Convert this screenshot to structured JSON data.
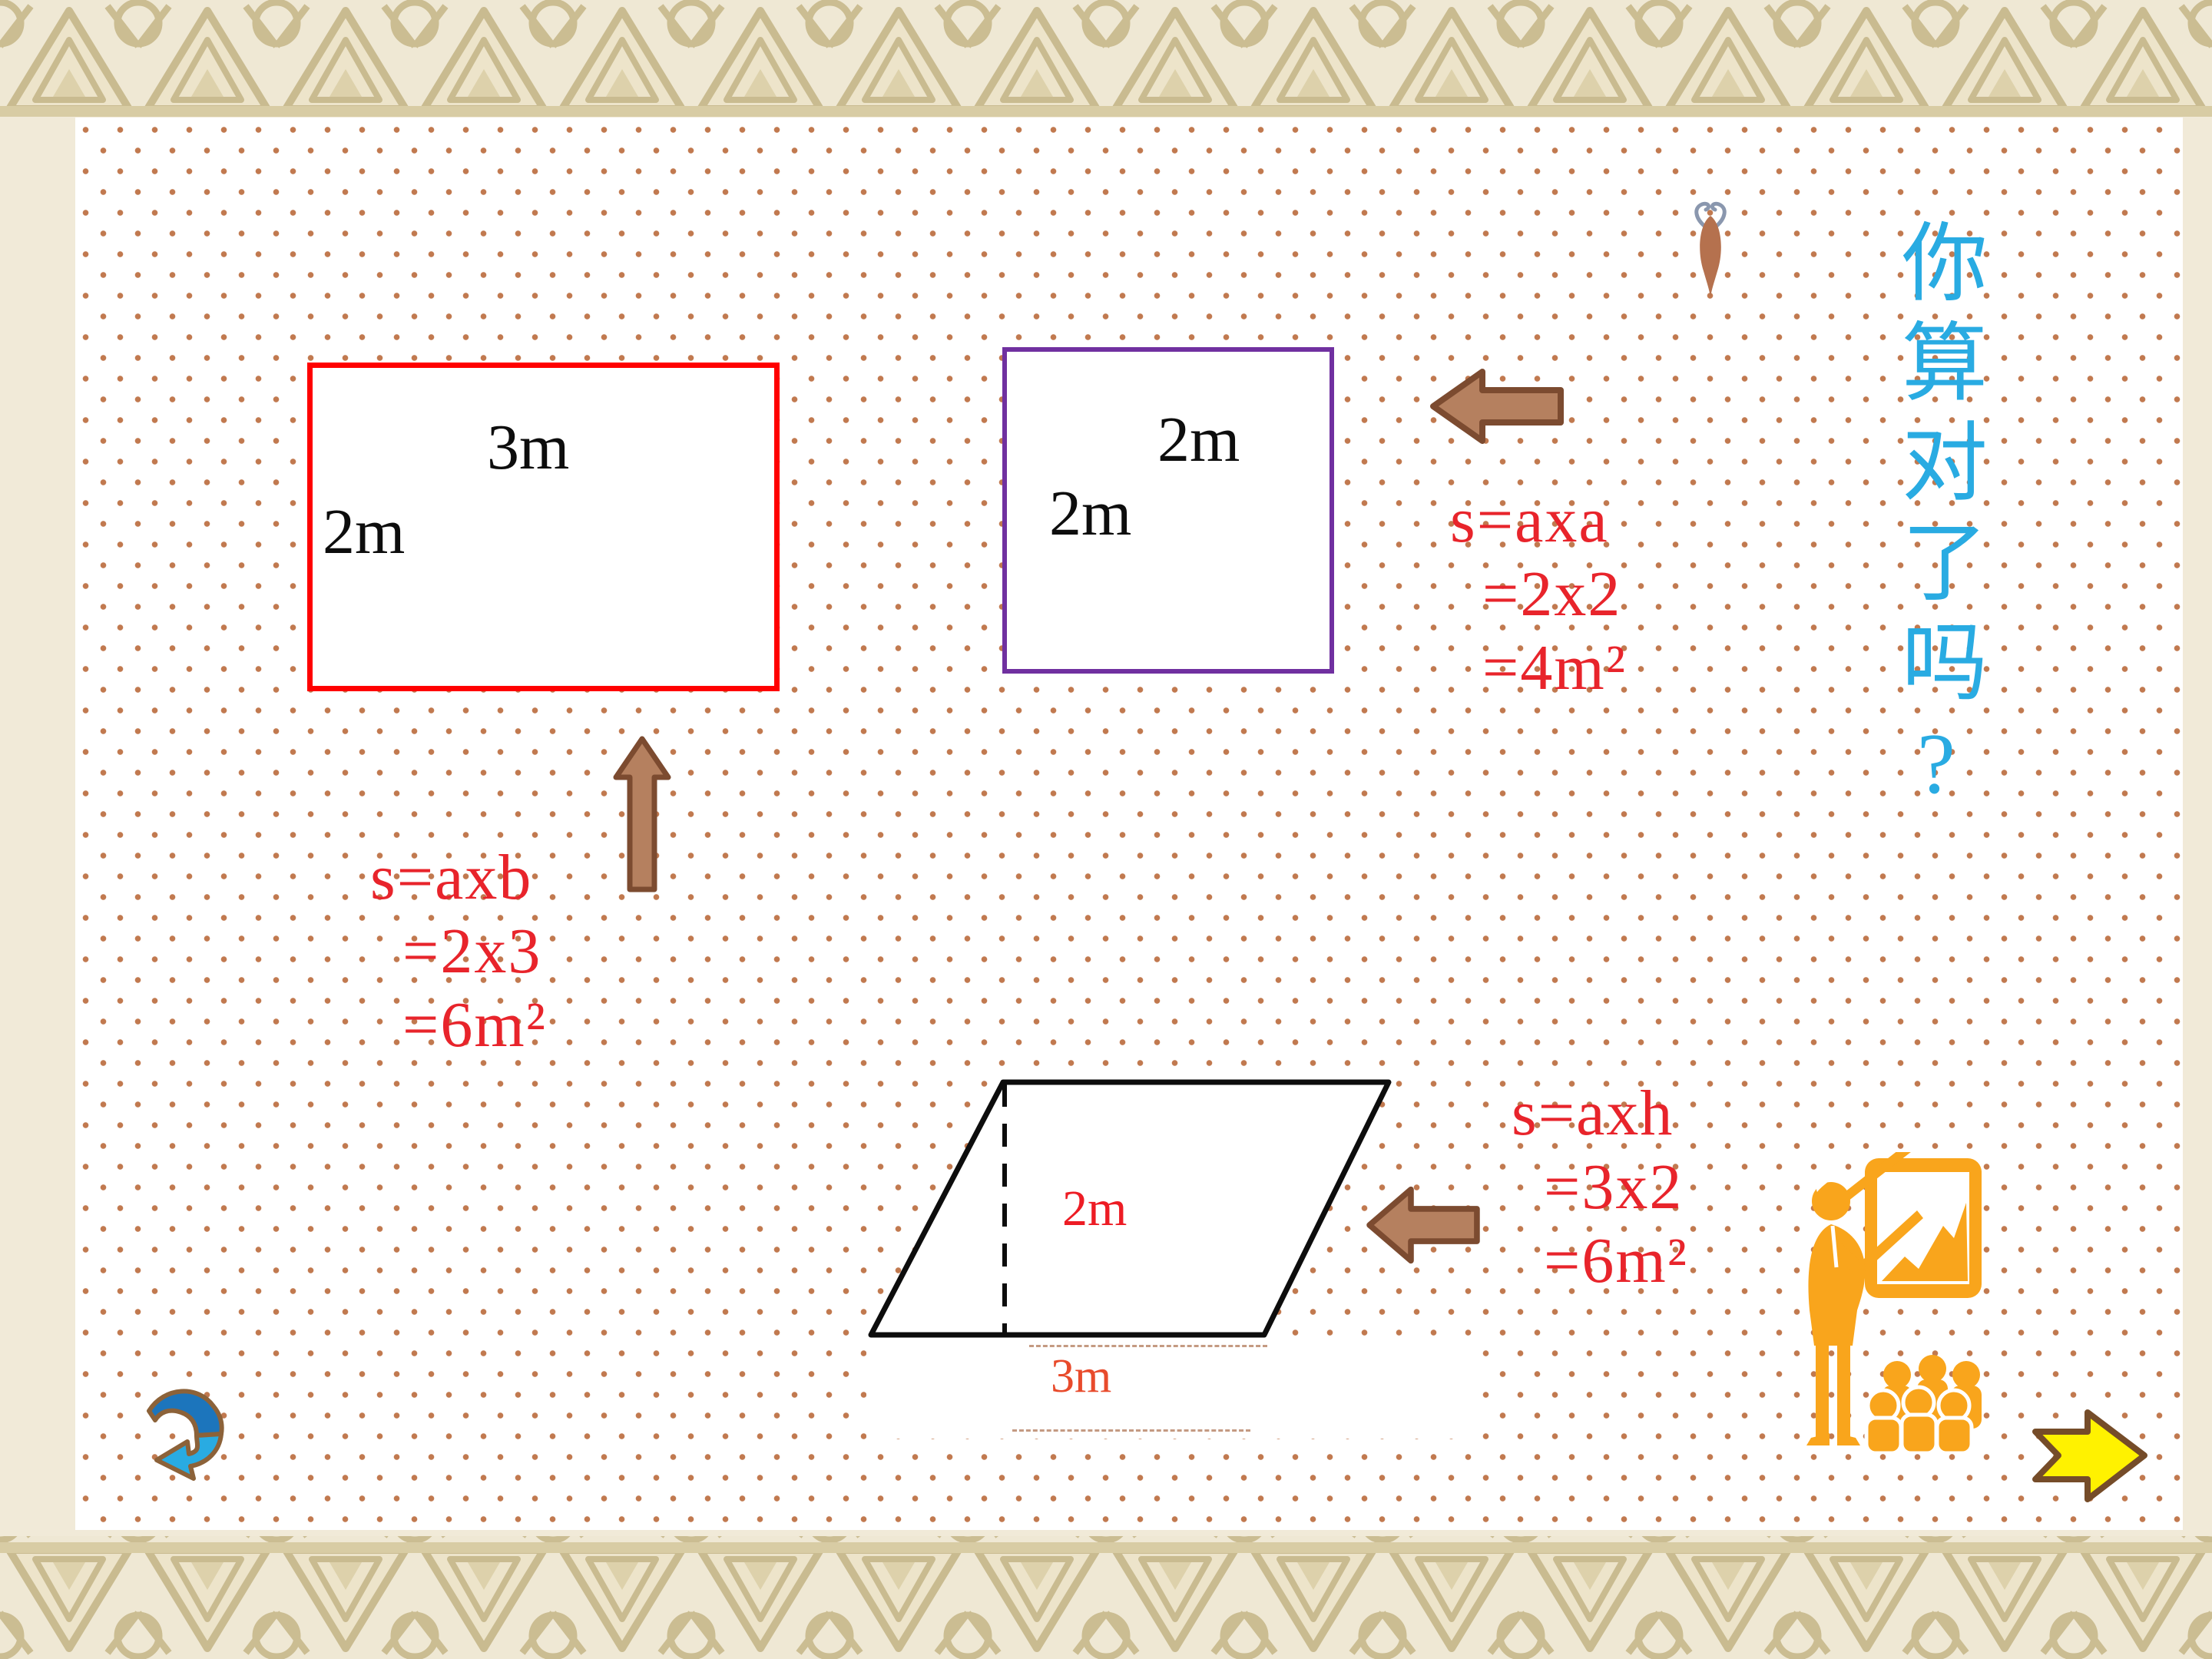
{
  "slide": {
    "question": "你算对了吗?",
    "labels": {
      "rect_width": "3m",
      "rect_height": "2m",
      "square_top": "2m",
      "square_side": "2m",
      "para_height": "2m",
      "para_base": "3m"
    },
    "formulas": {
      "rectangle": [
        "s=axb",
        "=2x3",
        "=6m²"
      ],
      "square": [
        "s=axa",
        "=2x2",
        "=4m²"
      ],
      "parallelogram": [
        "s=axh",
        "=3x2",
        "=6m²"
      ]
    },
    "icons": {
      "back_arrow": "curved-back-arrow",
      "next_arrow": "yellow-next-arrow",
      "up_arrow": "brown-up-arrow",
      "square_left_arrow": "brown-left-arrow",
      "parallelogram_left_arrow": "brown-left-arrow",
      "bug": "bug",
      "presenter": "presenter-at-chart-board-with-audience"
    },
    "colors": {
      "rectangle_border": "#ff0000",
      "square_border": "#7030a0",
      "formula_text": "#e8242b",
      "question_text": "#29abe2",
      "background_dot": "#c1794f",
      "border_pattern": "#c9bb90",
      "arrow_brown_fill": "#b5805f",
      "arrow_brown_stroke": "#7c4b30",
      "clipart_orange": "#f9a51c",
      "next_arrow_yellow": "#fff200",
      "back_arrow_blue_dark": "#1c75bc",
      "back_arrow_blue_light": "#29abe2"
    }
  }
}
